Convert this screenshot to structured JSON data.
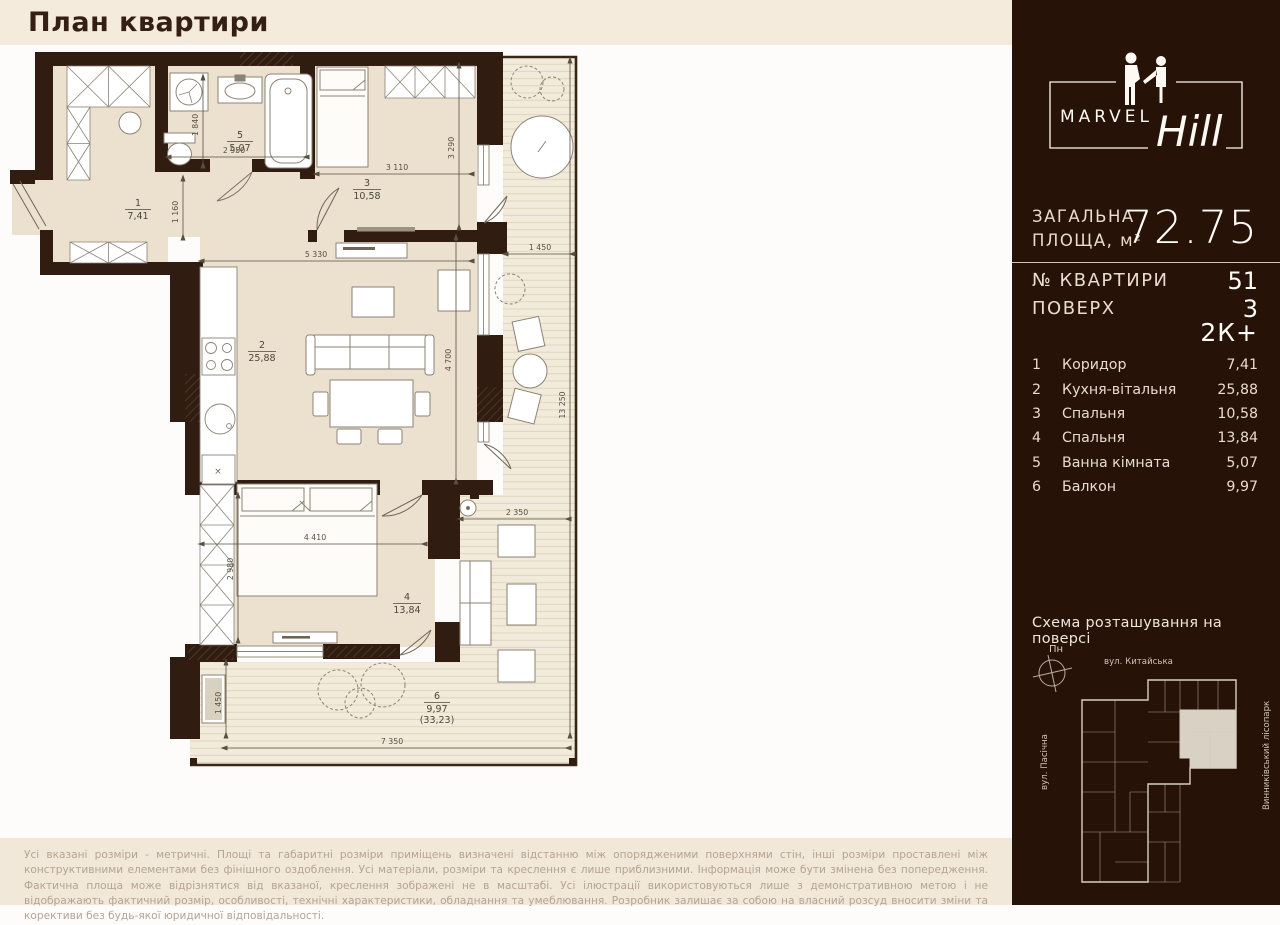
{
  "header": {
    "title": "План квартири"
  },
  "compass": {
    "label": "Пн"
  },
  "sidebar": {
    "brand": {
      "name_caps": "MARVEL",
      "name_script": "Hill"
    },
    "total_area": {
      "label_line1": "ЗАГАЛЬНА",
      "label_line2": "ПЛОЩА, м²",
      "value": "72.75"
    },
    "apartment_number": {
      "label": "№ КВАРТИРИ",
      "value": "51"
    },
    "floor": {
      "label": "ПОВЕРХ",
      "value": "3"
    },
    "layout_type": "2К+",
    "rooms": [
      {
        "num": "1",
        "name": "Коридор",
        "area": "7,41"
      },
      {
        "num": "2",
        "name": "Кухня-вітальня",
        "area": "25,88"
      },
      {
        "num": "3",
        "name": "Спальня",
        "area": "10,58"
      },
      {
        "num": "4",
        "name": "Спальня",
        "area": "13,84"
      },
      {
        "num": "5",
        "name": "Ванна кімната",
        "area": "5,07"
      },
      {
        "num": "6",
        "name": "Балкон",
        "area": "9,97"
      }
    ],
    "floor_scheme": {
      "title": "Схема розташування на поверсі",
      "compass_label": "Пн",
      "street_top": "вул. Китайська",
      "street_left": "вул. Пасічна",
      "park_right": "Винниківський лісопарк"
    }
  },
  "plan": {
    "labels": {
      "r1": {
        "num": "1",
        "area": "7,41"
      },
      "r2": {
        "num": "2",
        "area": "25,88"
      },
      "r3": {
        "num": "3",
        "area": "10,58"
      },
      "r4": {
        "num": "4",
        "area": "13,84"
      },
      "r5": {
        "num": "5",
        "area": "5,07"
      },
      "r6": {
        "num": "6",
        "area": "9,97",
        "area_total": "(33,23)"
      }
    },
    "dims": [
      "1 840",
      "2 950",
      "1 160",
      "5 330",
      "3 110",
      "3 290",
      "1 450",
      "4 700",
      "13 250",
      "2 350",
      "4 410",
      "2 980",
      "1 450",
      "7 350"
    ]
  },
  "footer": {
    "disclaimer": "Усі вказані розміри - метричні. Площі та габаритні розміри приміщень визначені відстанню між опорядженими поверхнями стін, інші розміри проставлені між конструктивними елементами без фінішного оздоблення. Усі матеріали, розміри та креслення є лише приблизними. Інформація може бути змінена без попередження. Фактична площа може відрізнятися від вказаної, креслення зображені не в масштабі. Усі ілюстрації використовуються лише з демонстративною метою і не відображають фактичний розмір, особливості, технічні характеристики, обладнання та умеблювання. Розробник залишає за собою на власний розсуд вносити зміни та корективи без будь-якої юридичної відповідальності."
  },
  "colors": {
    "wall": "#301c10",
    "floor": "#ece1cf",
    "deck": "#f2ebdb",
    "sidebar_bg": "#271208",
    "band_bg": "#f4ebdc",
    "accent_text": "#fffdf8"
  }
}
